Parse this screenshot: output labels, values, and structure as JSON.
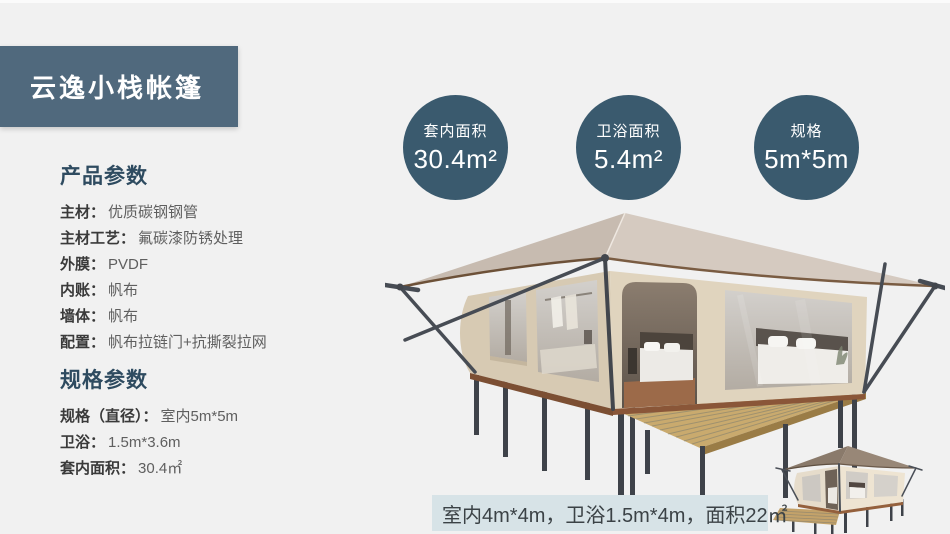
{
  "page": {
    "background": "#f1f1f1",
    "top_strip": "#fbfbfb"
  },
  "header": {
    "title": "云逸小栈帐篷",
    "bg_color": "#50697d",
    "text_color": "#ffffff"
  },
  "stat_circles": {
    "bg_color": "#3a5a6e",
    "items": [
      {
        "label": "套内面积",
        "value": "30.4m²"
      },
      {
        "label": "卫浴面积",
        "value": "5.4m²"
      },
      {
        "label": "规格",
        "value": "5m*5m"
      }
    ]
  },
  "product_params": {
    "heading": "产品参数",
    "heading_color": "#2e4b60",
    "items": [
      {
        "label": "主材：",
        "value": "优质碳钢钢管"
      },
      {
        "label": "主材工艺：",
        "value": "氟碳漆防锈处理"
      },
      {
        "label": "外膜：",
        "value": "PVDF"
      },
      {
        "label": "内账：",
        "value": "帆布"
      },
      {
        "label": "墙体：",
        "value": "帆布"
      },
      {
        "label": "配置：",
        "value": "帆布拉链门+抗撕裂拉网"
      }
    ]
  },
  "spec_params": {
    "heading": "规格参数",
    "items": [
      {
        "label": "规格（直径）：",
        "value": "室内5m*5m"
      },
      {
        "label": "卫浴：",
        "value": "1.5m*3.6m"
      },
      {
        "label": "套内面积：",
        "value": "30.4㎡"
      }
    ]
  },
  "caption": {
    "text": "室内4m*4m，卫浴1.5m*4m，面积22㎡",
    "bg_color": "#d7e3e7"
  },
  "illustrations": {
    "main_tent": "safari-glamping-tent-3d-render",
    "thumb_tent": "small-glamping-tent-with-deck-render",
    "colors": {
      "roof_left": "#c7bbb0",
      "roof_right": "#d5cac0",
      "wall_left": "#d7cab3",
      "wall_right": "#e0d4be",
      "deck": "#c9aa6e",
      "frame": "#42464d",
      "base_trim": "#7c4f33",
      "thumb_roof": "#8a7a6b"
    }
  }
}
